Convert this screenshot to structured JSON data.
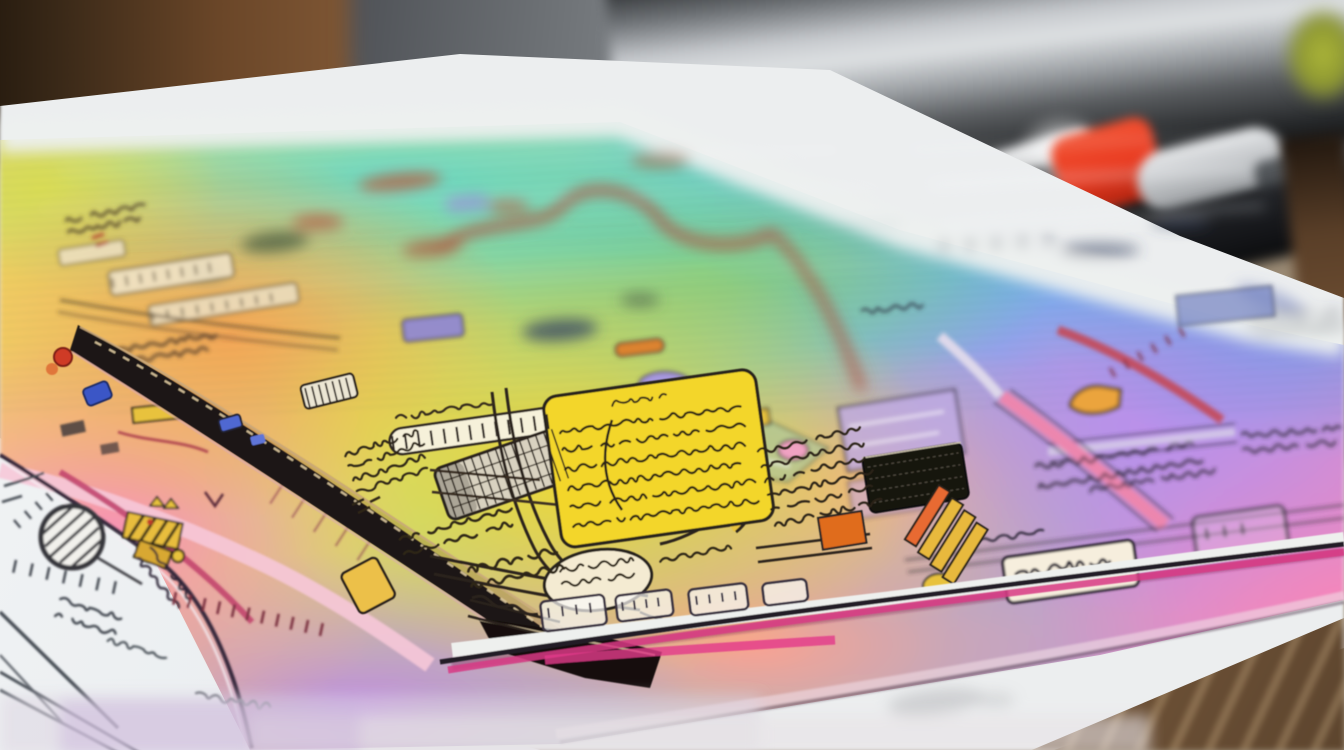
{
  "scene": {
    "type": "photograph",
    "description": "Close-up photograph of a colorful hand-drawn rainbow-gradient street map folded on a wooden desk. A white pencil-sketch sheet lies beneath it, and a silver laptop edge, a metal cup and a pen with a red grip are blurred in the background.",
    "objects": [
      {
        "name": "rainbow-map-sheet",
        "label": "Hand-drawn rainbow map sheet"
      },
      {
        "name": "folded-map-spine",
        "label": "Dark stitched spine of the folded map"
      },
      {
        "name": "sketch-paper",
        "label": "White pencil sketch sheet"
      },
      {
        "name": "wooden-desk",
        "label": "Wooden desk surface"
      },
      {
        "name": "metal-cup",
        "label": "Blurred metal cup"
      },
      {
        "name": "laptop-edge",
        "label": "Blurred silver laptop edge"
      },
      {
        "name": "pen",
        "label": "Pen with red grip"
      }
    ],
    "text_content": {
      "legible": false,
      "note": "All handwriting and labels on the map are illegible scribbles; no readable text appears in the image."
    },
    "palette": {
      "wood_dark": "#241a10",
      "wood": "#7b5434",
      "wood_light": "#9a7a52",
      "paper_white": "#edeff0",
      "sketch_ink": "#464d55",
      "map_teal": "#6ed2c0",
      "map_blue": "#5cb0e8",
      "map_green": "#8cc87a",
      "map_yellow": "#f2d235",
      "map_orange": "#eca45c",
      "map_pink": "#ee8fb2",
      "map_salmon": "#efa092",
      "map_lavender": "#b48ee0",
      "map_magenta": "#d83a84",
      "ink_dark": "#29221a",
      "spine_black": "#1c1814",
      "pen_red": "#e8391f",
      "metal_silver": "#c7cacd",
      "accent_gold": "#e8b93c",
      "wall_gray": "#7d8185",
      "blob_green": "#aeb83a"
    }
  }
}
